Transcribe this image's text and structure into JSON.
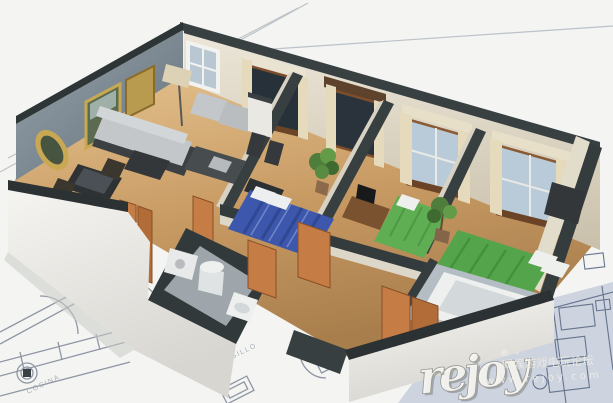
{
  "watermark": {
    "logo_text": "rejoy",
    "registered_mark": "®",
    "tagline_cn": "网娱游戏电玩论坛",
    "site_url": "www.rejoy.com"
  },
  "blueprint": {
    "label_hallway": "PASILLO",
    "label_kitchen": "COCINA",
    "section_marker": "A"
  },
  "scene": {
    "description": "3D isometric cutaway render of an apartment floor plan sitting on an architectural blueprint sheet",
    "rooms": [
      "living-room",
      "kitchen",
      "bedroom-1",
      "bedroom-2",
      "bedroom-3",
      "bathroom-1",
      "bathroom-2",
      "hallway"
    ],
    "colors": {
      "paper": "#f4f5f2",
      "blueprint_line": "#8e96a4",
      "blueprint_zone": "#cdd4df",
      "wall_top": "#343b3d",
      "wall_face": "#e9e4d6",
      "accent_wall": "#7e8a94",
      "floor_wood": "#c99a62",
      "door_orange": "#c57d45",
      "bed_blue": "#3c57ab",
      "bed_green": "#5aa950",
      "sofa_gray": "#c3c7ca",
      "plant_green": "#4e7d3c",
      "curtain_cream": "#e6dabd",
      "window_glass": "#b9cbd8",
      "fixture_white": "#edf0ef"
    }
  }
}
